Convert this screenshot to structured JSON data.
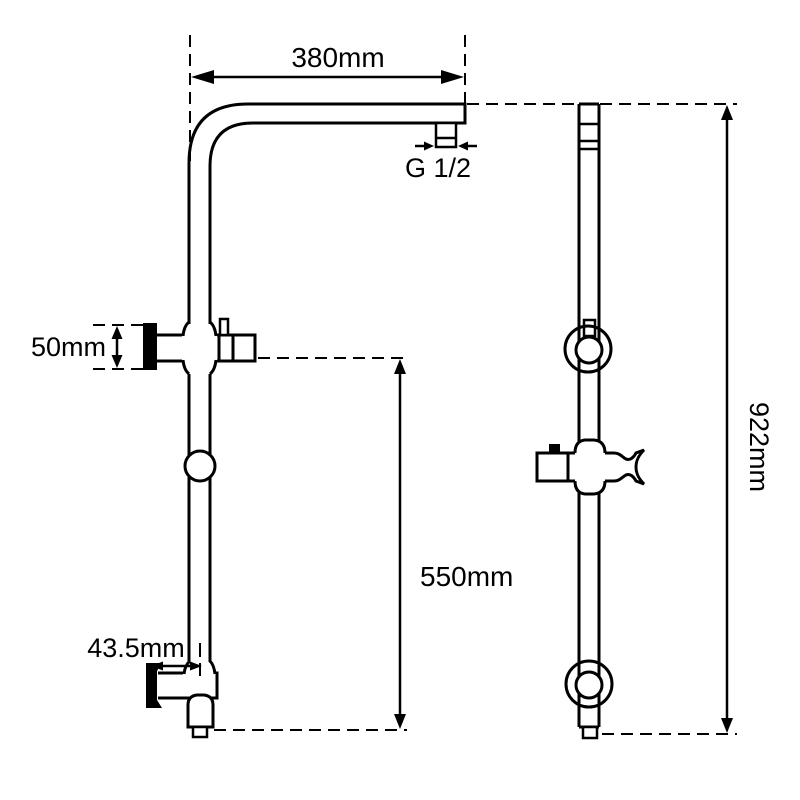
{
  "colors": {
    "line": "#000000",
    "background": "#ffffff",
    "text": "#000000"
  },
  "labels": {
    "arm_length": "380mm",
    "thread_size": "G 1/2",
    "bracket_height": "50mm",
    "wall_offset": "43.5mm",
    "rail_length": "550mm",
    "overall_height": "922mm"
  }
}
